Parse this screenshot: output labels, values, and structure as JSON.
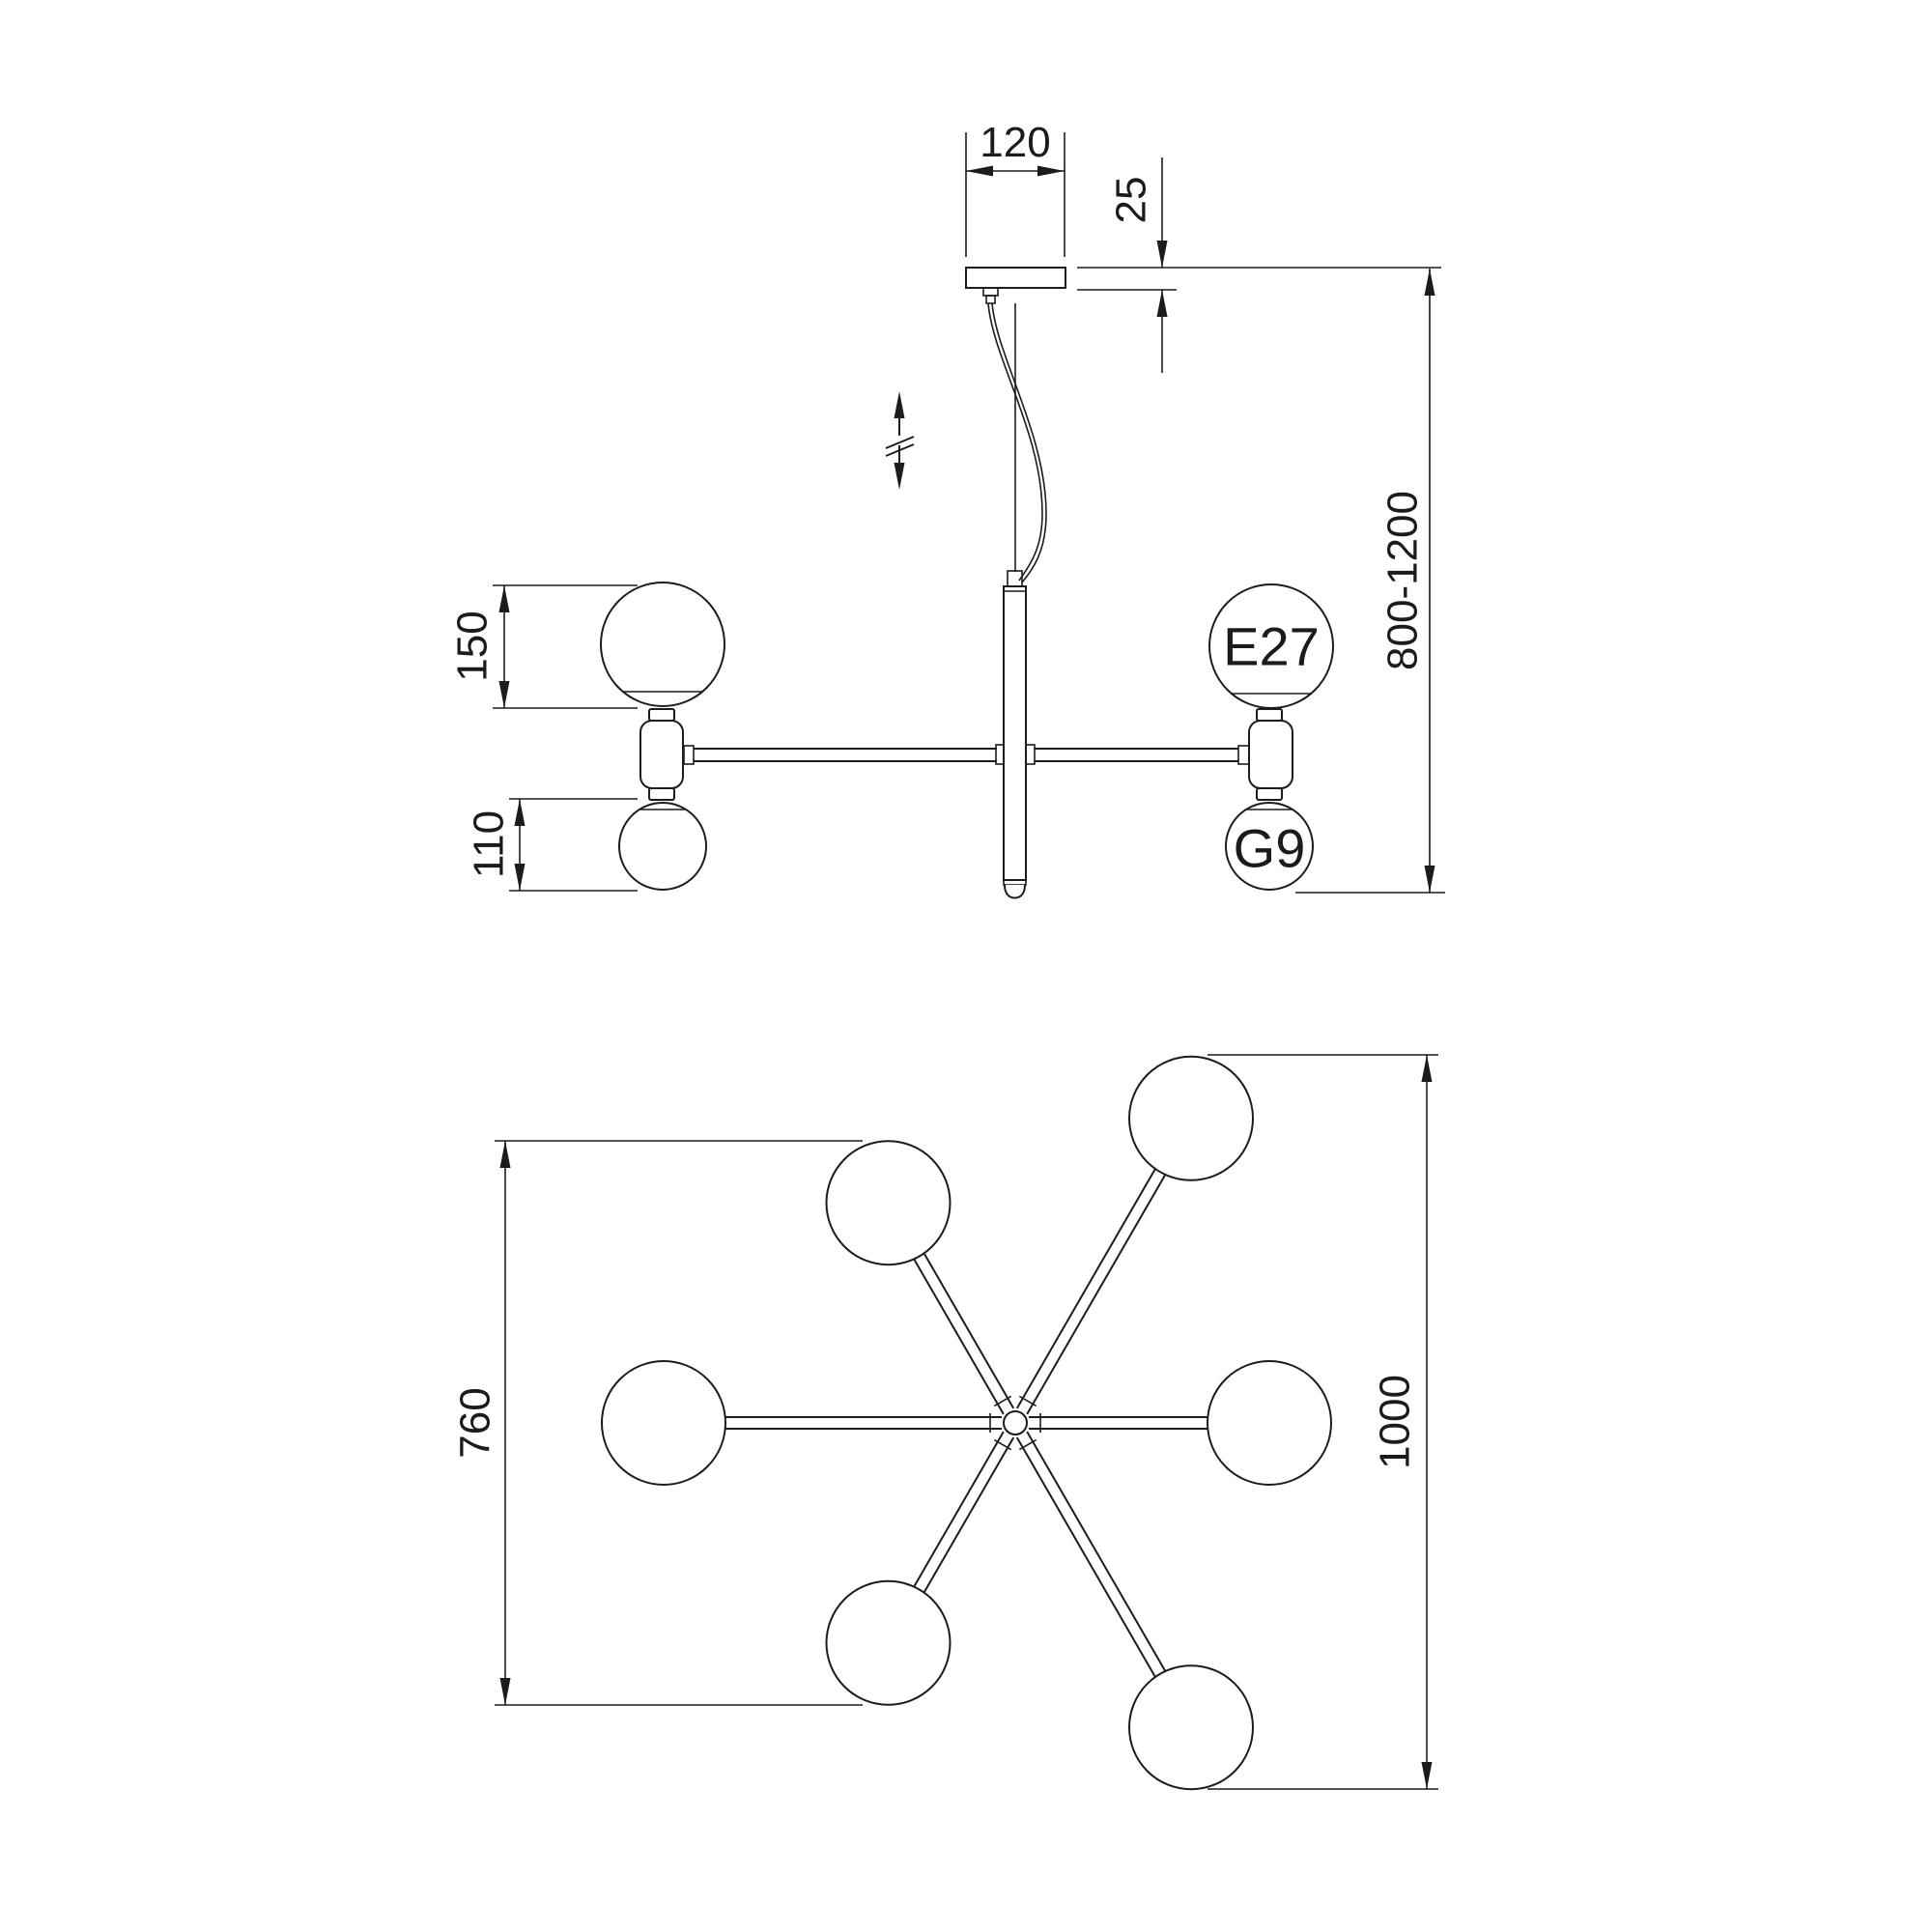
{
  "drawing": {
    "background": "#ffffff",
    "line_color": "#1c1c1c",
    "front_view": {
      "canopy_width_mm": "120",
      "canopy_height_mm": "25",
      "suspension_range_mm": "800-1200",
      "large_globe_mm": "150",
      "small_globe_mm": "110",
      "large_socket": "E27",
      "small_socket": "G9"
    },
    "top_view": {
      "inner_span_mm": "760",
      "outer_span_mm": "1000"
    }
  }
}
